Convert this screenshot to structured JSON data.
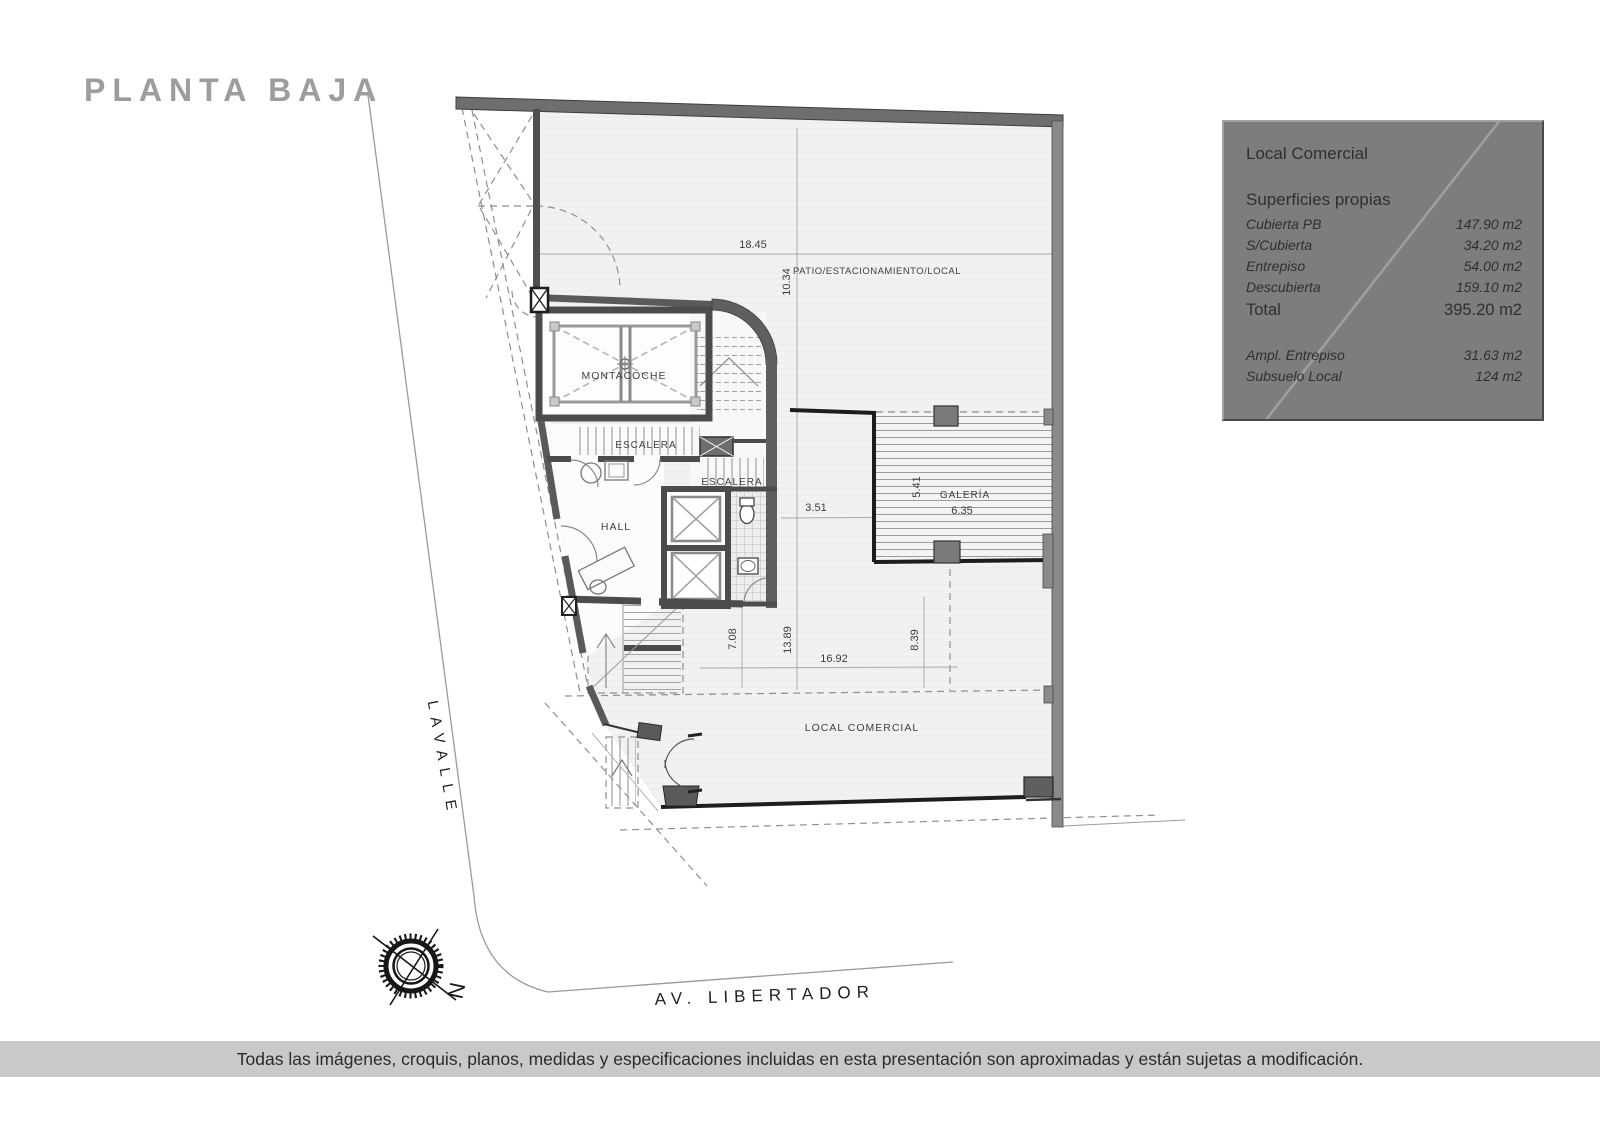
{
  "page": {
    "title": "PLANTA BAJA",
    "disclaimer": "Todas las imágenes, croquis, planos, medidas y especificaciones incluidas en esta presentación son aproximadas y están sujetas a modificación."
  },
  "info_box": {
    "title": "Local Comercial",
    "section_title": "Superficies propias",
    "rows": [
      {
        "label": "Cubierta PB",
        "value": "147.90 m2"
      },
      {
        "label": "S/Cubierta",
        "value": "34.20 m2"
      },
      {
        "label": "Entrepiso",
        "value": "54.00 m2"
      },
      {
        "label": "Descubierta",
        "value": "159.10 m2"
      }
    ],
    "total": {
      "label": "Total",
      "value": "395.20 m2"
    },
    "extra_rows": [
      {
        "label": "Ampl. Entrepiso",
        "value": "31.63 m2"
      },
      {
        "label": "Subsuelo Local",
        "value": "124 m2"
      }
    ]
  },
  "plan": {
    "labels": {
      "patio": "PATIO/ESTACIONAMIENTO/LOCAL",
      "montacoche": "MONTACOCHE",
      "escalera_upper": "ESCALERA",
      "escalera_lower": "ESCALERA",
      "hall": "HALL",
      "galeria": "GALERÍA",
      "local": "LOCAL COMERCIAL"
    },
    "dimensions": {
      "patio_width": "18.45",
      "patio_depth": "10.34",
      "hall_to_galeria": "3.51",
      "galeria_depth": "5.41",
      "galeria_width": "6.35",
      "local_left_depth": "7.08",
      "local_mid_depth": "13.89",
      "local_width": "16.92",
      "local_right_depth": "8.39"
    },
    "streets": {
      "left": "LAVALLE",
      "bottom": "AV. LIBERTADOR"
    },
    "compass": {
      "north": "N"
    }
  },
  "colors": {
    "title_text": "#9d9d9d",
    "info_box_bg": "#7d7d7d",
    "info_box_text": "#2f2f2f",
    "disclaimer_bg": "#c9c9c9",
    "disclaimer_text": "#2b2b2b",
    "wall_dark": "#6e6e6e",
    "wall_medium": "#8a8a8a",
    "wall_interior": "#4c4c4c",
    "floor_light": "#f2f2f1",
    "line_black": "#1d1d1d"
  }
}
